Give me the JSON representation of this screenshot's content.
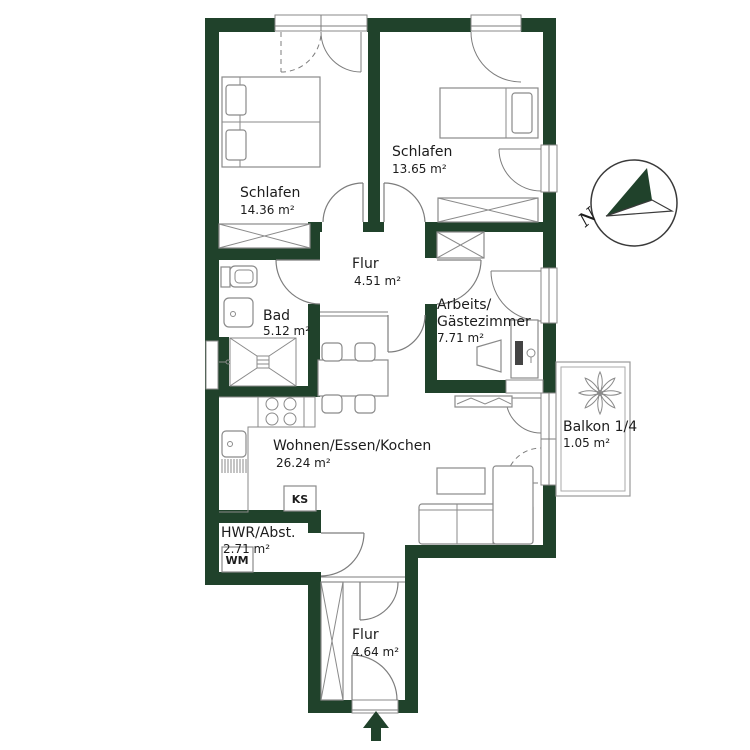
{
  "plan": {
    "rooms": {
      "schlafen1": {
        "name": "Schlafen",
        "area": "14.36 m²"
      },
      "schlafen2": {
        "name": "Schlafen",
        "area": "13.65 m²"
      },
      "flur_upper": {
        "name": "Flur",
        "area": "4.51 m²"
      },
      "bad": {
        "name": "Bad",
        "area": "5.12 m²"
      },
      "arbeitszimmer": {
        "name_line1": "Arbeits/",
        "name_line2": "Gästezimmer",
        "area": "7.71 m²"
      },
      "wohnen": {
        "name": "Wohnen/Essen/Kochen",
        "area": "26.24 m²"
      },
      "balkon": {
        "name": "Balkon 1/4",
        "area": "1.05 m²"
      },
      "hwr": {
        "name": "HWR/Abst.",
        "area": "2.71 m²"
      },
      "flur_lower": {
        "name": "Flur",
        "area": "4.64 m²"
      }
    },
    "appliances": {
      "fridge_label": "KS",
      "washing_machine_label": "WM"
    },
    "compass": {
      "north_label": "N"
    },
    "colors": {
      "wall": "#20422b",
      "line": "#7d7d7d",
      "text": "#1c1c1c"
    }
  }
}
